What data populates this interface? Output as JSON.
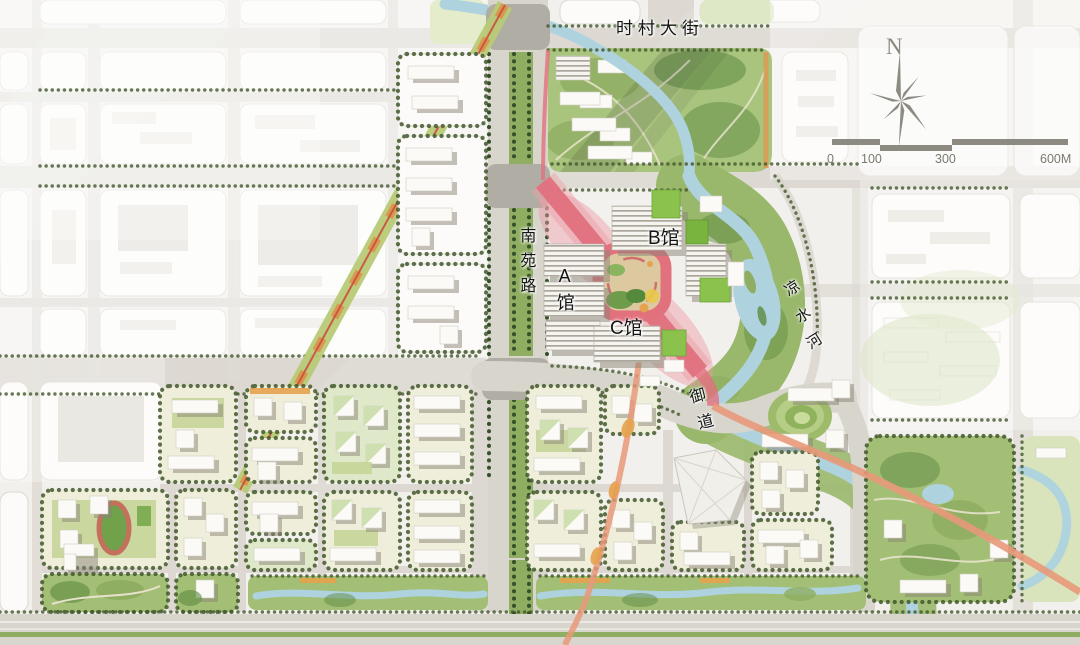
{
  "map": {
    "labels": {
      "street_top": "时村大街",
      "road_nanyuan": "南苑路",
      "hall_a": "A馆",
      "hall_b": "B馆",
      "hall_c": "C馆",
      "royal_way": "御道",
      "river": "凉水河"
    },
    "compass": {
      "north": "N"
    },
    "scalebar": {
      "t0": "0",
      "t1": "100",
      "t2": "300",
      "t3": "600M"
    }
  },
  "colors": {
    "axis_pink": "#e2717e",
    "salmon": "#e8997a",
    "road_gray": "#d8d5cd",
    "park_green": "#a3bf76",
    "water_blue": "#aed3de",
    "tree_green": "#42582c",
    "accent_orange": "#e6a24e",
    "track_red": "#c4705c",
    "roof_green": "#8bc24d"
  }
}
